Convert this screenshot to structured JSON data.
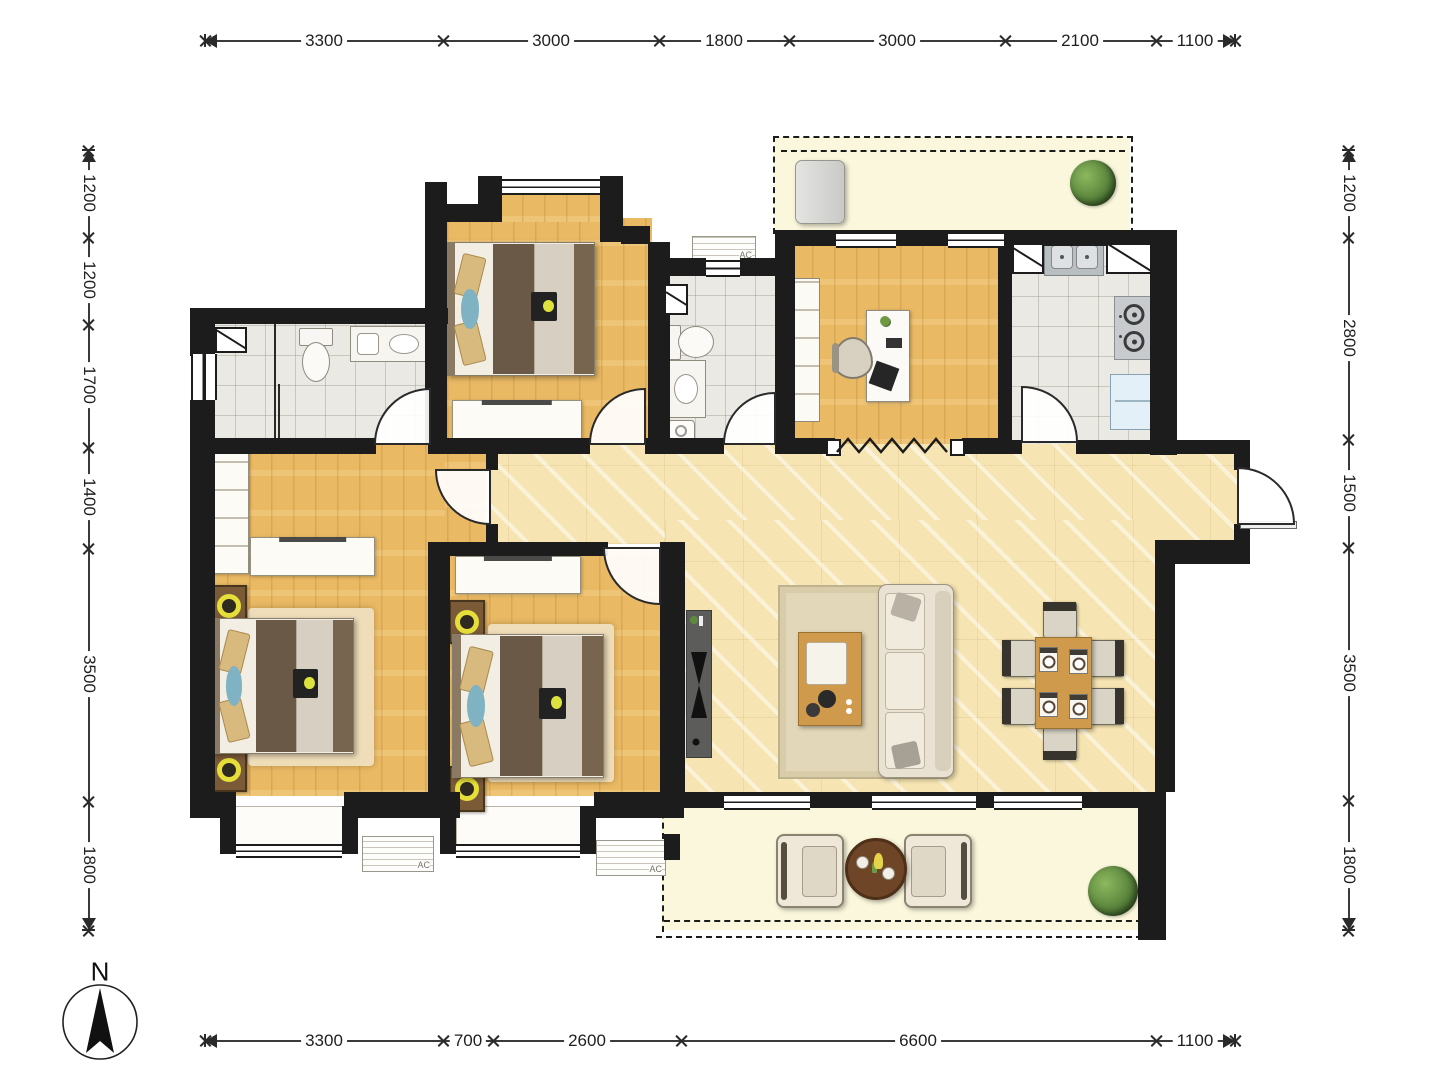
{
  "title": "apartment-floor-plan",
  "compass": {
    "label": "N"
  },
  "labels": {
    "ac": "AC"
  },
  "colors": {
    "wall": "#1c1c1c",
    "wood_floor": "#e9b964",
    "tile_floor": "#ebe9e4",
    "marble_floor": "#f6e5b2",
    "balcony_floor": "#faf7dc",
    "lamp_accent": "#e6df3a",
    "blanket": "#6b5947",
    "furniture_wood": "#cf9a4c"
  },
  "dim_lines": [
    {
      "id": "top",
      "orientation": "h",
      "x1": 205,
      "x2": 1235,
      "y": 40,
      "ticks": [
        205,
        443,
        659,
        789,
        1005,
        1156,
        1235
      ],
      "segments": [
        {
          "label": "3300",
          "mid": 324
        },
        {
          "label": "3000",
          "mid": 551
        },
        {
          "label": "1800",
          "mid": 724
        },
        {
          "label": "3000",
          "mid": 897
        },
        {
          "label": "2100",
          "mid": 1080
        },
        {
          "label": "1100",
          "mid": 1195
        }
      ]
    },
    {
      "id": "bottom",
      "orientation": "h",
      "x1": 205,
      "x2": 1235,
      "y": 1040,
      "ticks": [
        205,
        443,
        493,
        681,
        1156,
        1235
      ],
      "segments": [
        {
          "label": "3300",
          "mid": 324
        },
        {
          "label": "700",
          "mid": 468
        },
        {
          "label": "2600",
          "mid": 587
        },
        {
          "label": "6600",
          "mid": 918
        },
        {
          "label": "1100",
          "mid": 1195
        }
      ]
    },
    {
      "id": "left",
      "orientation": "v",
      "y1": 150,
      "y2": 930,
      "x": 88,
      "ticks": [
        150,
        237,
        324,
        447,
        548,
        801,
        930
      ],
      "segments": [
        {
          "label": "1200",
          "mid": 193
        },
        {
          "label": "1200",
          "mid": 280
        },
        {
          "label": "1700",
          "mid": 385
        },
        {
          "label": "1400",
          "mid": 497
        },
        {
          "label": "3500",
          "mid": 674
        },
        {
          "label": "1800",
          "mid": 865
        }
      ]
    },
    {
      "id": "right",
      "orientation": "v",
      "y1": 150,
      "y2": 930,
      "x": 1348,
      "ticks": [
        150,
        237,
        439,
        547,
        800,
        930
      ],
      "segments": [
        {
          "label": "1200",
          "mid": 193
        },
        {
          "label": "2800",
          "mid": 338
        },
        {
          "label": "1500",
          "mid": 493
        },
        {
          "label": "3500",
          "mid": 673
        },
        {
          "label": "1800",
          "mid": 865
        }
      ]
    }
  ]
}
